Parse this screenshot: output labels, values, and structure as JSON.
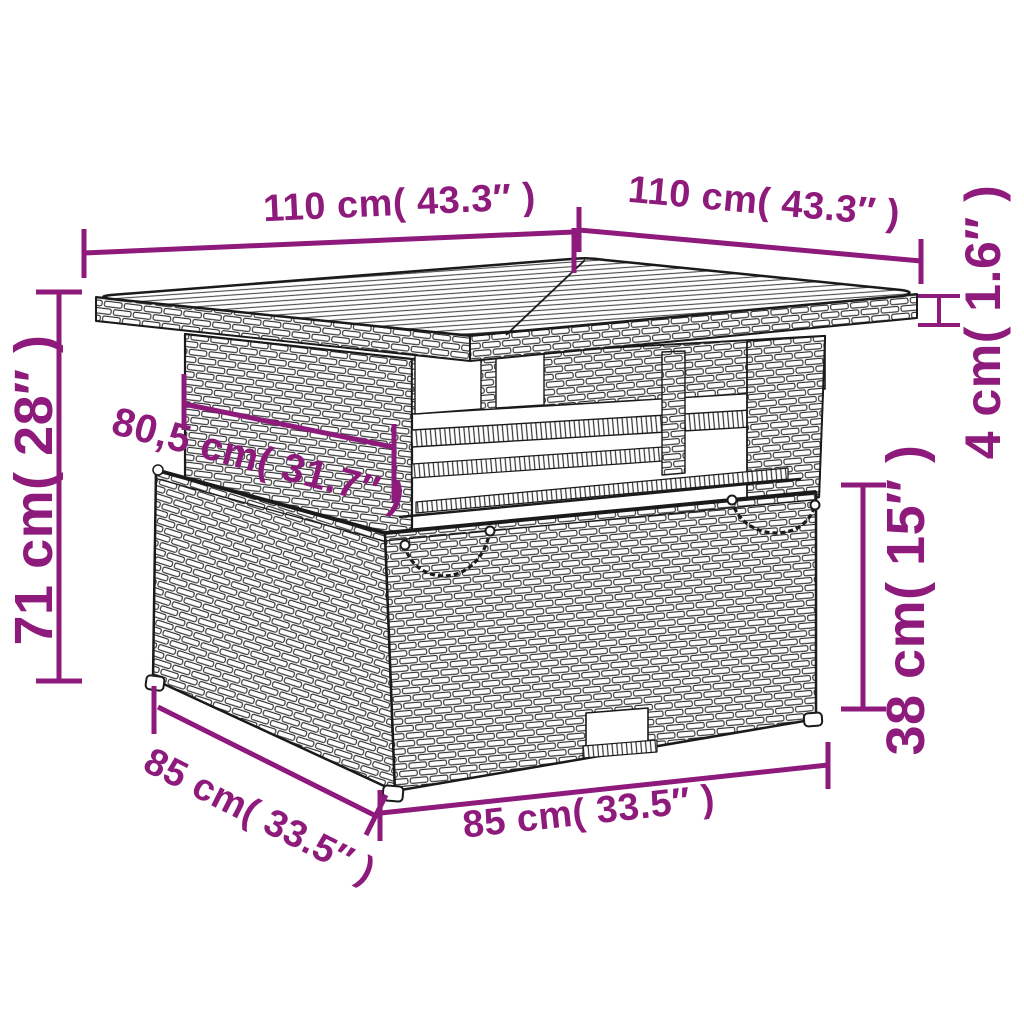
{
  "page": {
    "background": "#ffffff"
  },
  "diagram": {
    "subject": "rattan-garden-table-dimension-drawing",
    "accent_color": "#8e1a7c",
    "line_color": "#1a1a1a",
    "dimensions": {
      "top_width": "110 cm( 43.3″ )",
      "top_depth": "110 cm( 43.3″ )",
      "top_thickness": "4 cm( 1.6″ )",
      "total_height": "71 cm( 28″ )",
      "pedestal_depth": "80,5 cm( 31.7″ )",
      "base_height": "38 cm( 15″ )",
      "base_depth": "85 cm( 33.5″ )",
      "base_width": "85 cm( 33.5″ )"
    }
  }
}
